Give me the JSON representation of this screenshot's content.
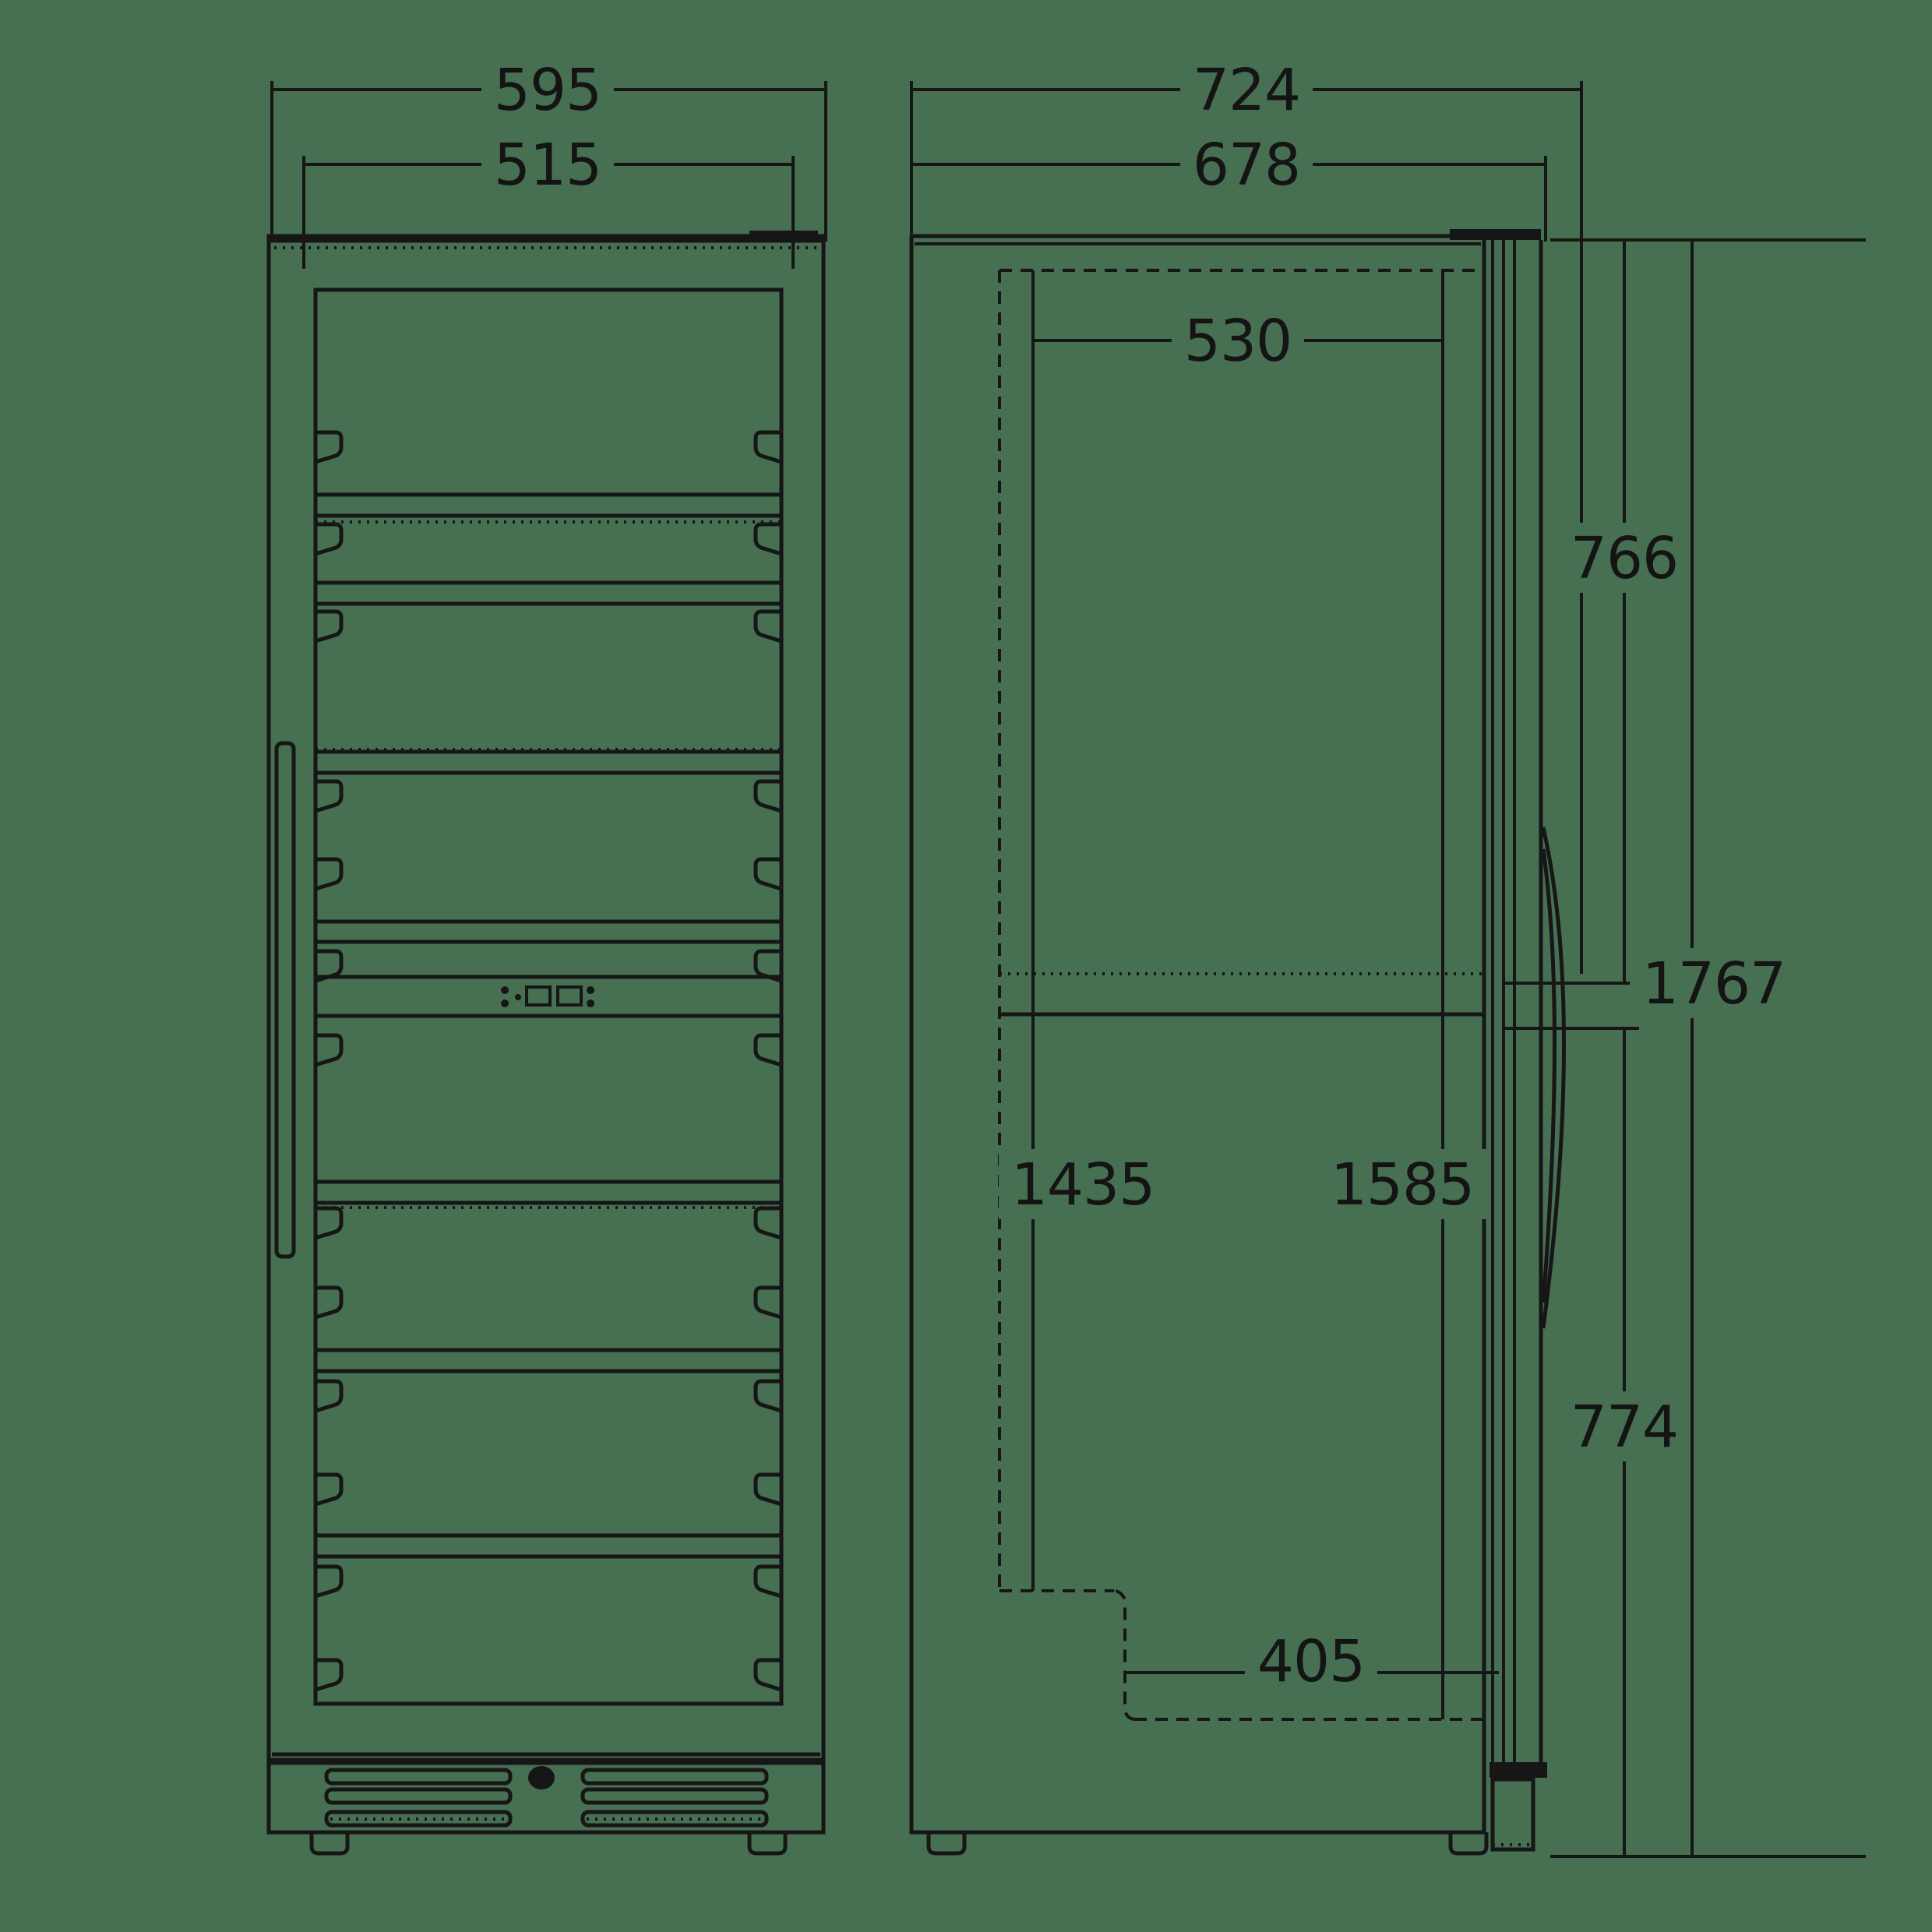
{
  "page": {
    "type": "technical-dimension-drawing",
    "subject": "upright glass-door beverage / wine cooler, front view and side view",
    "background_color": "#476f52",
    "line_color": "#161616"
  },
  "dimensions_mm": {
    "front_overall_width": "595",
    "front_inner_width": "515",
    "side_overall_depth": "724",
    "side_door_depth": "678",
    "side_interior_depth": "530",
    "side_top_to_handle": "766",
    "side_overall_height": "1767",
    "side_interior_height_back": "1435",
    "side_interior_height_front": "1585",
    "side_handle_to_floor": "774",
    "side_base_interior_depth": "405"
  },
  "icons": {
    "lock": "keyhole-lock-icon",
    "control_buttons_left": "led-button-dots-icon",
    "display_left": "display-window-icon",
    "display_right": "display-window-icon",
    "control_buttons_right": "led-button-dots-icon"
  }
}
